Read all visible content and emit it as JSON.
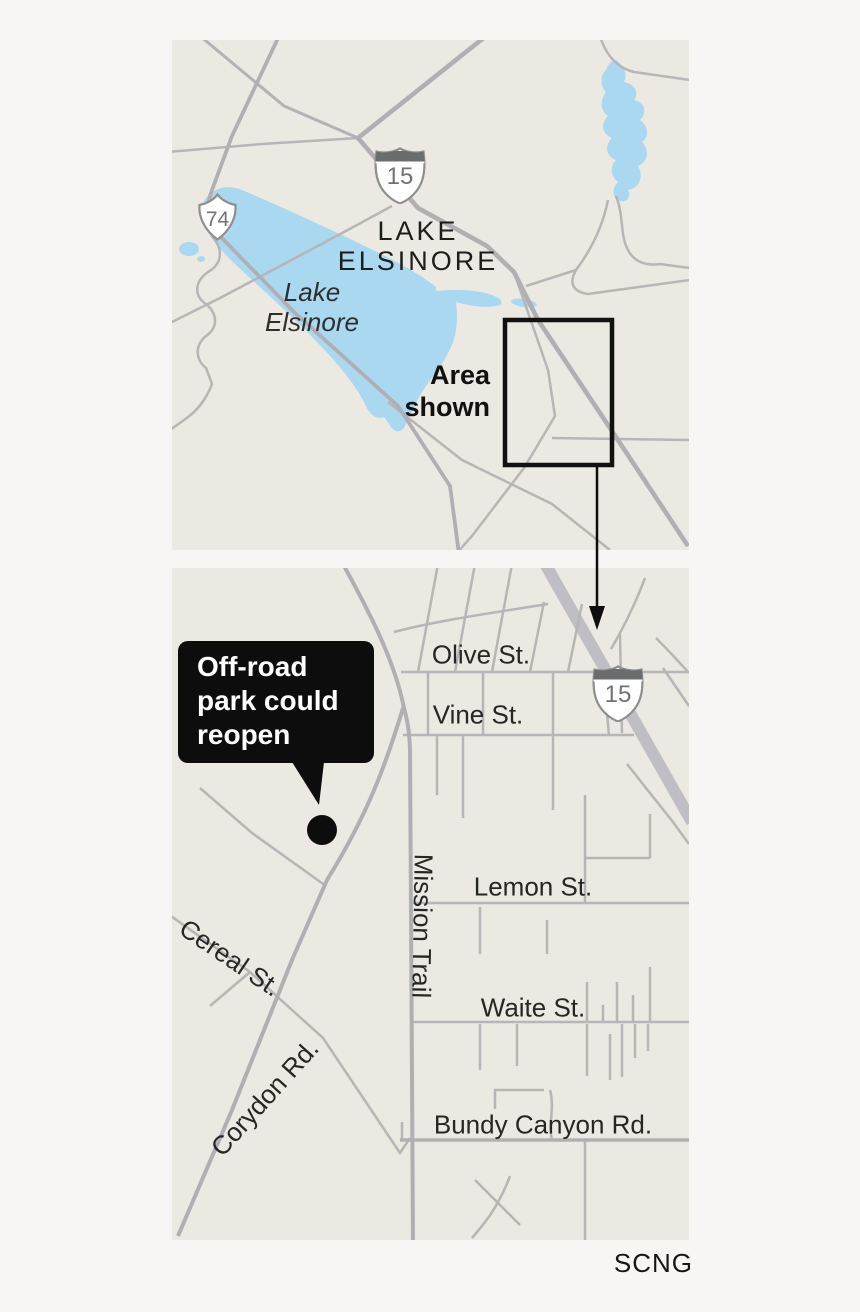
{
  "credit": {
    "label": "SCNG"
  },
  "overview_map": {
    "city": {
      "lines": [
        "LAKE",
        "ELSINORE"
      ]
    },
    "lake": {
      "lines": [
        "Lake",
        "Elsinore"
      ]
    },
    "area_box": {
      "lines": [
        "Area",
        "shown"
      ]
    },
    "shields": {
      "interstate_15": "15",
      "route_74": "74"
    }
  },
  "detail_map": {
    "callout": {
      "lines": [
        "Off-road",
        "park could",
        "reopen"
      ]
    },
    "shields": {
      "interstate_15": "15"
    },
    "streets": {
      "olive": "Olive St.",
      "vine": "Vine St.",
      "lemon": "Lemon St.",
      "waite": "Waite St.",
      "bundy_canyon": "Bundy Canyon Rd.",
      "mission_trail": "Mission Trail",
      "cereal": "Cereal St.",
      "corydon": "Corydon Rd."
    }
  },
  "colors": {
    "page_bg": "#f7f6f5",
    "panel_bg": "#ece9e2",
    "road_minor": "#b7b5b8",
    "road_medium": "#b1afb4",
    "freeway": "#c0bec5",
    "lake_fill": "#a9d8f0",
    "callout_bg": "#0d0d0d",
    "marker": "#0d0d0d"
  }
}
